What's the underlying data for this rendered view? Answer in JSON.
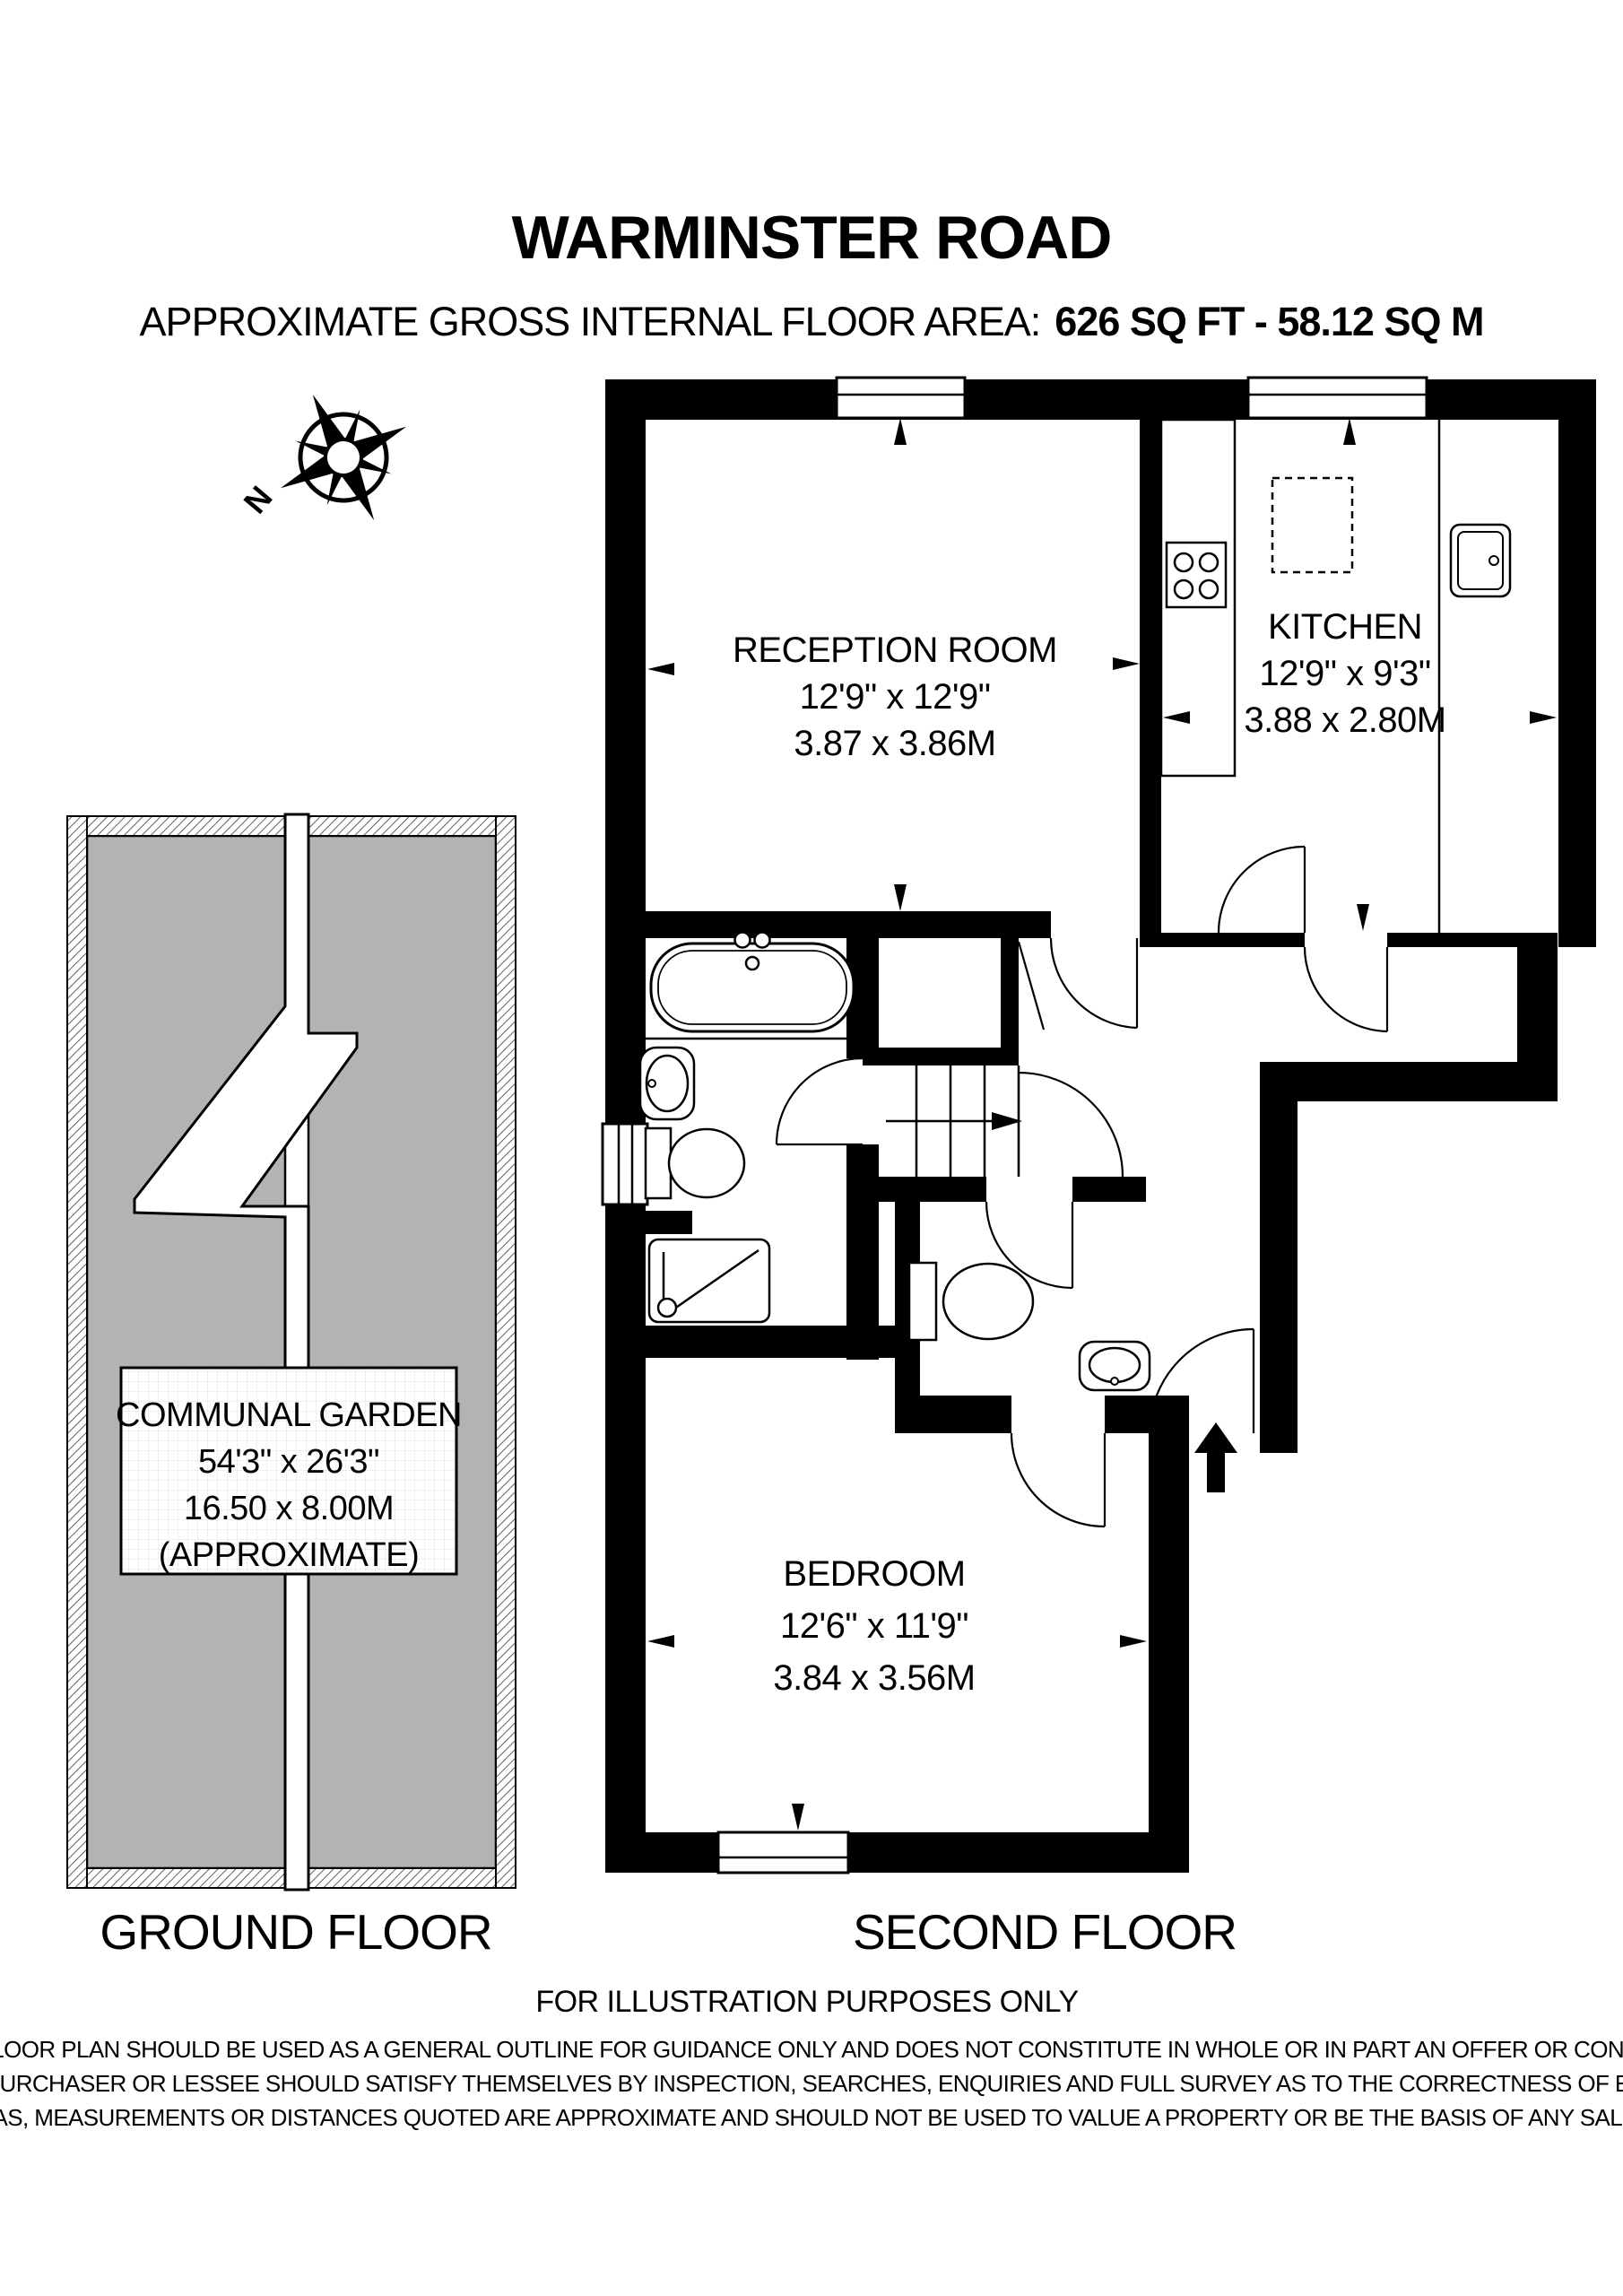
{
  "header": {
    "title": "WARMINSTER ROAD",
    "area_label": "APPROXIMATE GROSS INTERNAL FLOOR AREA:",
    "area_value": "626 SQ FT - 58.12 SQ M"
  },
  "compass": {
    "north_label": "N"
  },
  "rooms": {
    "reception": {
      "name": "RECEPTION ROOM",
      "imperial": "12'9\" x 12'9\"",
      "metric": "3.87 x 3.86M"
    },
    "kitchen": {
      "name": "KITCHEN",
      "imperial": "12'9\" x 9'3\"",
      "metric": "3.88 x 2.80M"
    },
    "bedroom": {
      "name": "BEDROOM",
      "imperial": "12'6\" x 11'9\"",
      "metric": "3.84 x 3.56M"
    },
    "garden": {
      "name": "COMMUNAL GARDEN",
      "imperial": "54'3\" x 26'3\"",
      "metric": "16.50 x 8.00M",
      "note": "(APPROXIMATE)"
    }
  },
  "floors": {
    "ground": "GROUND FLOOR",
    "second": "SECOND FLOOR"
  },
  "footer": {
    "illustration_note": "FOR ILLUSTRATION PURPOSES ONLY",
    "disclaimer_lines": [
      "THIS FLOOR PLAN SHOULD BE USED AS A GENERAL OUTLINE FOR GUIDANCE ONLY AND DOES NOT CONSTITUTE IN WHOLE OR IN PART AN OFFER OR CONTRACT.",
      "ANY INTENDING PURCHASER OR LESSEE SHOULD SATISFY THEMSELVES BY INSPECTION, SEARCHES, ENQUIRIES AND FULL SURVEY AS TO THE CORRECTNESS OF EACH STATEMENT.",
      "ANY AREAS, MEASUREMENTS OR DISTANCES QUOTED ARE APPROXIMATE AND SHOULD NOT BE USED TO VALUE A PROPERTY OR BE THE BASIS OF ANY SALE OR LET."
    ]
  },
  "colors": {
    "wall": "#000000",
    "garden_fill": "#b3b3b3",
    "background": "#ffffff"
  }
}
